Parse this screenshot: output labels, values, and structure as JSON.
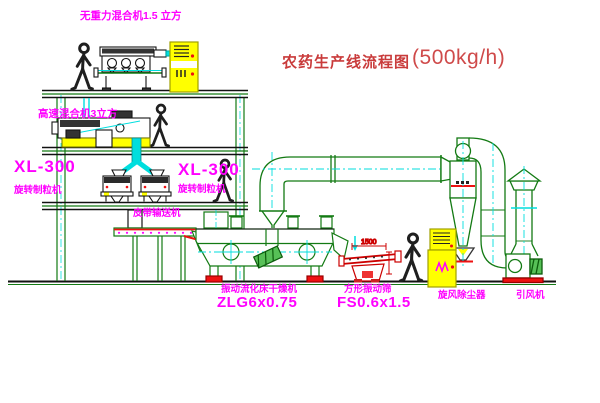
{
  "title": {
    "zh": "农药生产线流程图",
    "capacity": "(500kg/h)"
  },
  "labels": {
    "gravity_mixer": "无重力混合机1.5 立方",
    "high_speed_mixer": "高速混合机3立方",
    "granulator_left_model": "XL-300",
    "granulator_left_name": "旋转制粒机",
    "granulator_right_model": "XL-300",
    "granulator_right_name": "旋转制粒机",
    "belt_conveyor": "皮带输送机",
    "dryer_name": "振动流化床干燥机",
    "dryer_model": "ZLG6x0.75",
    "sieve_name": "方形振动筛",
    "sieve_model": "FS0.6x1.5",
    "cyclone": "旋风除尘器",
    "fan": "引风机"
  },
  "dimensions": {
    "sieve_length": "1500"
  },
  "palette": {
    "line_green": "#137a13",
    "centerline_cyan": "#00dede",
    "label_magenta": "#ff00ff",
    "title_red": "#cf4a4a",
    "cabinet_yellow": "#ffff00",
    "accent_red": "#ee1111"
  }
}
